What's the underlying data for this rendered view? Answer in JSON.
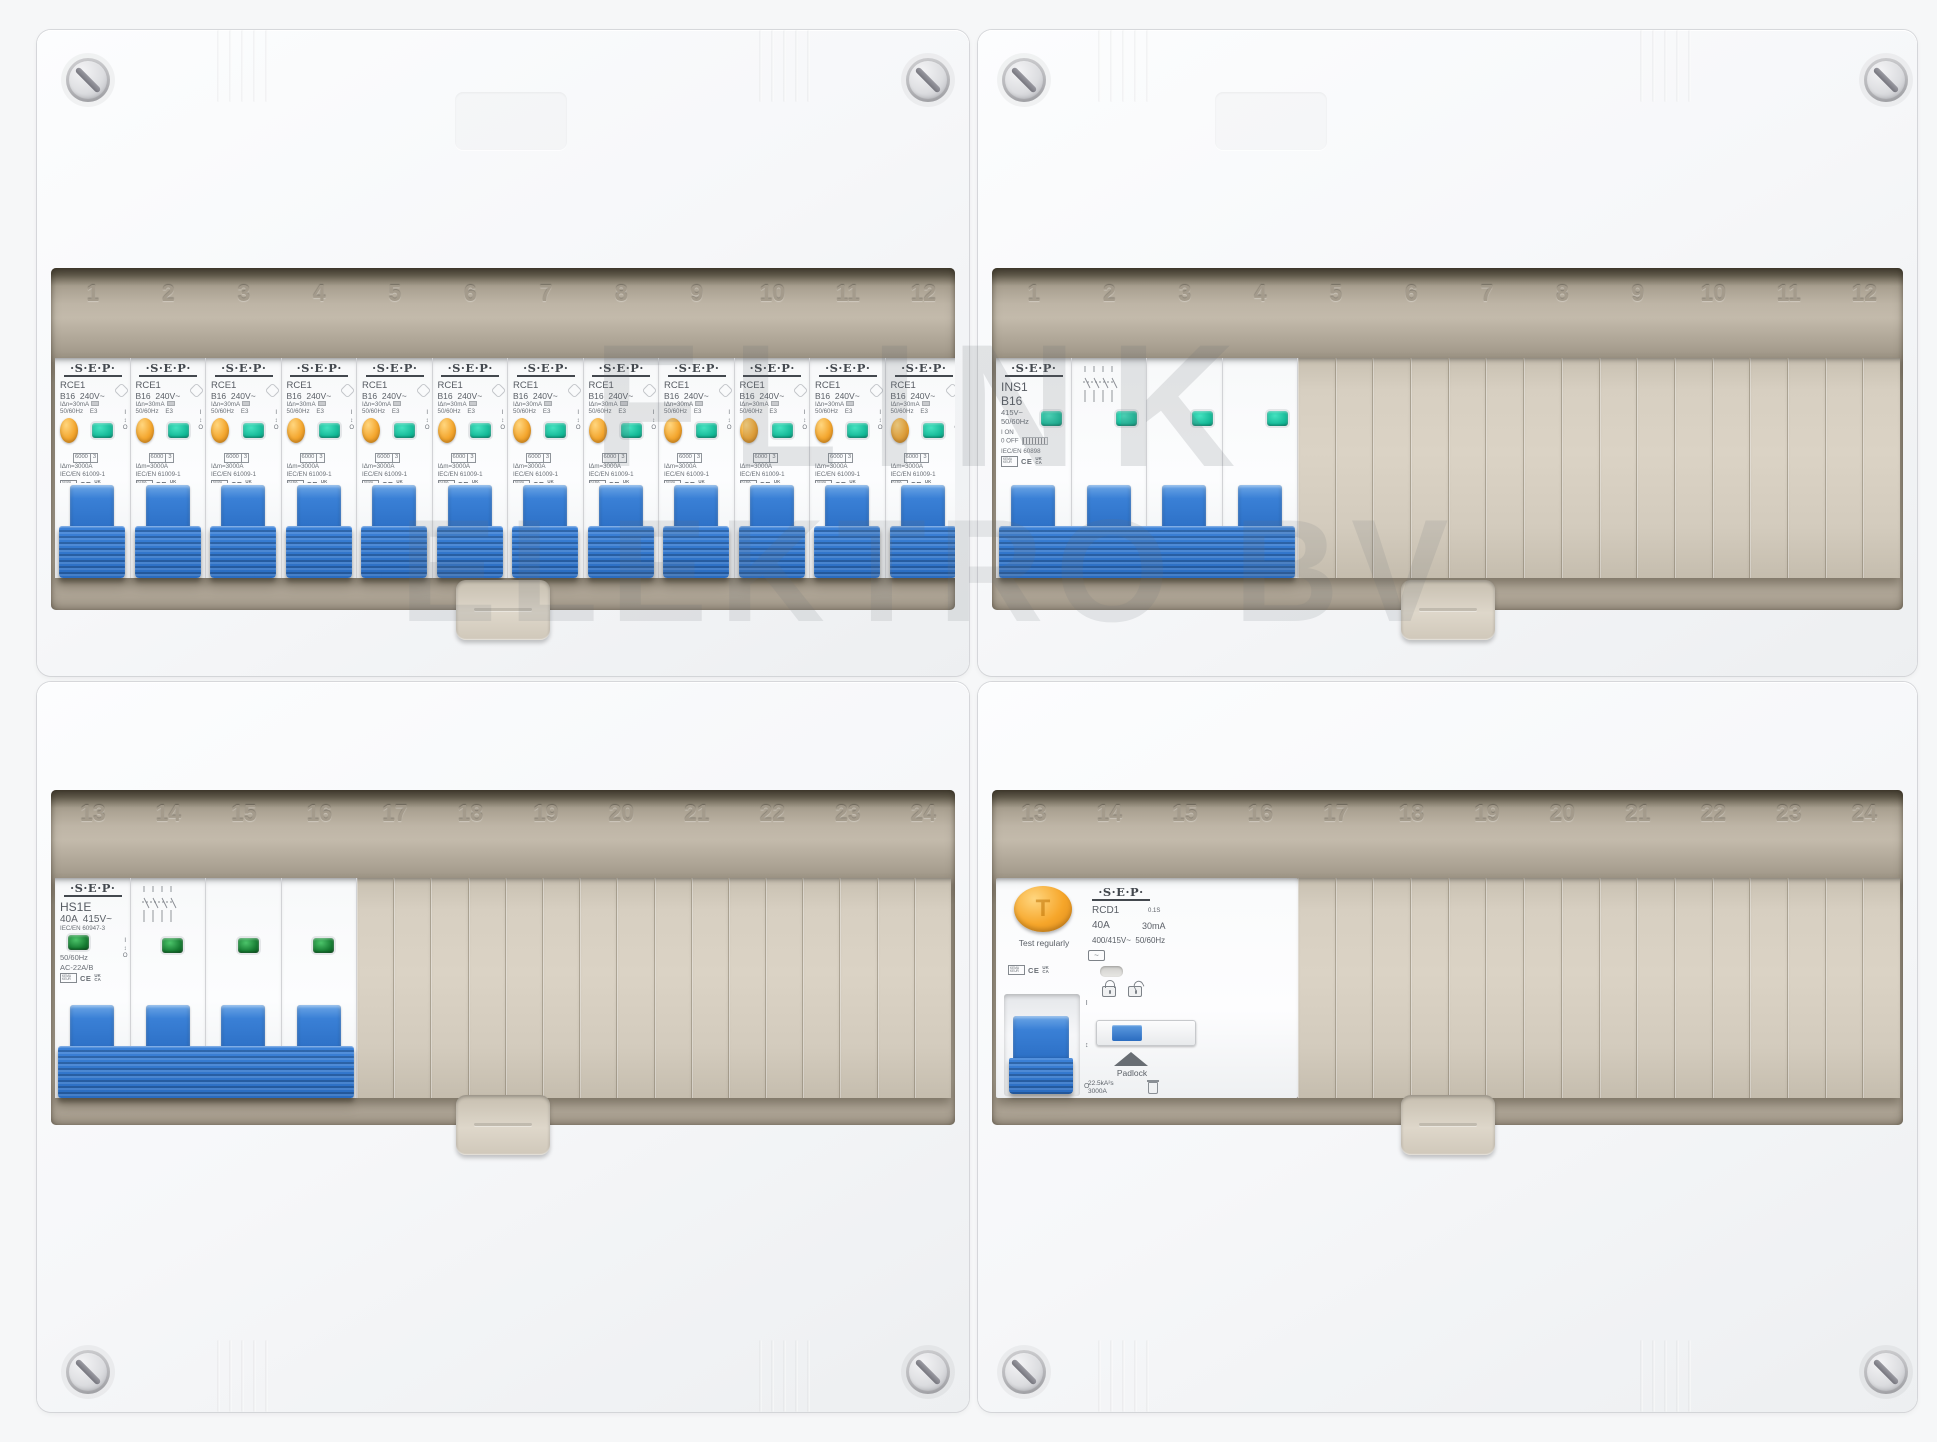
{
  "board": {
    "watermark_line1": "FLINK",
    "watermark_line2": "ELEKTRO BV"
  },
  "rails": {
    "top_left": [
      "1",
      "2",
      "3",
      "4",
      "5",
      "6",
      "7",
      "8",
      "9",
      "10",
      "11",
      "12"
    ],
    "top_right": [
      "1",
      "2",
      "3",
      "4",
      "5",
      "6",
      "7",
      "8",
      "9",
      "10",
      "11",
      "12"
    ],
    "bottom_left": [
      "13",
      "14",
      "15",
      "16",
      "17",
      "18",
      "19",
      "20",
      "21",
      "22",
      "23",
      "24"
    ],
    "bottom_right": [
      "13",
      "14",
      "15",
      "16",
      "17",
      "18",
      "19",
      "20",
      "21",
      "22",
      "23",
      "24"
    ]
  },
  "marks": {
    "kema": "KEMA KEUR",
    "ce": "CE",
    "ukca": "UK CA"
  },
  "devices": {
    "rcbo": {
      "count": 12,
      "brand": "·S·E·P·",
      "model": "RCE1",
      "rating_line": "B16  240V~",
      "trip_line": "IΔn=30mA",
      "freq_line": "50/60Hz    E3",
      "breaking_value": "6000",
      "breaking_class": "3",
      "im_line": "IΔm=3000A",
      "standard": "IEC/EN 61009-1",
      "io_on": "I",
      "io_arrows": "↕",
      "io_off": "O"
    },
    "isolator": {
      "brand": "·S·E·P·",
      "model": "INS1",
      "rating": "B16",
      "voltage": "415V~",
      "freq": "50/60Hz",
      "on_label": "I ON",
      "off_label": "0 OFF",
      "standard": "IEC/EN 60898"
    },
    "main_switch": {
      "brand": "·S·E·P·",
      "model": "HS1E",
      "rating_line": "40A  415V~",
      "standard": "IEC/EN 60947-3",
      "freq": "50/60Hz",
      "category": "AC-22A/B",
      "io_on": "I",
      "io_arrows": "↕",
      "io_off": "O"
    },
    "rcd": {
      "brand": "·S·E·P·",
      "model": "RCD1",
      "delay": "0.1S",
      "rating": "40A",
      "sensitivity": "30mA",
      "voltage_freq": "400/415V~  50/60Hz",
      "test_button": "T",
      "test_label": "Test regularly",
      "padlock_label": "Padlock",
      "i2t": "22.5kA²s",
      "breaking": "3000A",
      "io_on": "I",
      "io_arrows": "↕",
      "io_off": "O"
    }
  }
}
